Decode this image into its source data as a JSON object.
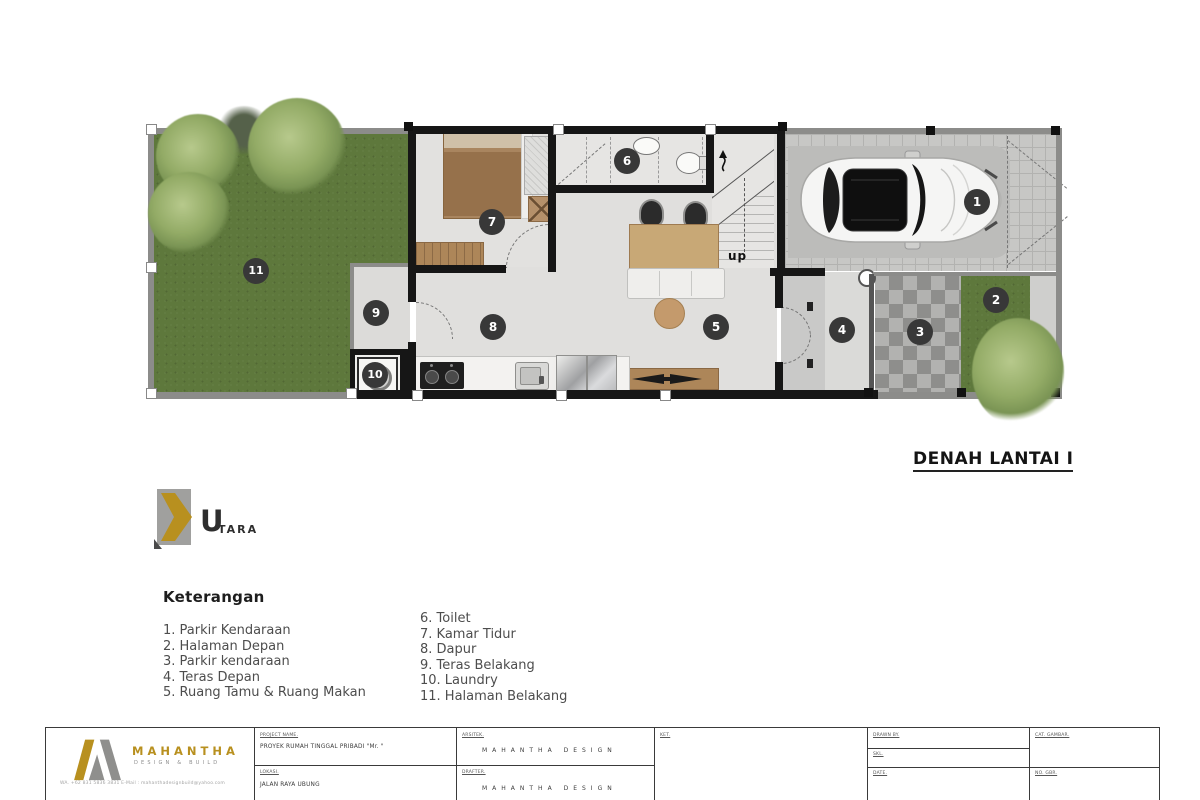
{
  "drawing_title": "DENAH LANTAI I",
  "north": {
    "initial": "U",
    "rest": "TARA"
  },
  "legend_heading": "Keterangan",
  "rooms": [
    {
      "num": "1",
      "name": "Parkir Kendaraan"
    },
    {
      "num": "2",
      "name": "Halaman Depan"
    },
    {
      "num": "3",
      "name": "Parkir kendaraan"
    },
    {
      "num": "4",
      "name": "Teras Depan"
    },
    {
      "num": "5",
      "name": "Ruang Tamu & Ruang Makan"
    },
    {
      "num": "6",
      "name": "Toilet"
    },
    {
      "num": "7",
      "name": "Kamar Tidur"
    },
    {
      "num": "8",
      "name": "Dapur"
    },
    {
      "num": "9",
      "name": "Teras Belakang"
    },
    {
      "num": "10",
      "name": "Laundry"
    },
    {
      "num": "11",
      "name": "Halaman Belakang"
    }
  ],
  "plan_labels": {
    "up": "up"
  },
  "title_block": {
    "company": "MAHANTHA",
    "tagline": "DESIGN & BUILD",
    "contact": "WA. +62 831 5836 3831   E-Mail : mahanthadesignbuild@yahoo.com",
    "fields": {
      "project_label": "PROJECT NAME.",
      "project_value": "PROYEK RUMAH TINGGAL PRIBADI \"Mr. \"",
      "location_label": "LOKASI.",
      "location_value": "JALAN RAYA UBUNG",
      "architect_label": "ARSITEK.",
      "architect_value": "MAHANTHA DESIGN",
      "drafter_label": "DRAFTER.",
      "drafter_value": "MAHANTHA DESIGN",
      "note_label": "KET.",
      "drawn_label": "DRAWN BY.",
      "scale_label": "SKL.",
      "date_label": "DATE.",
      "cat_label": "CAT. GAMBAR.",
      "sheet_label": "NO. GBR."
    }
  },
  "colors": {
    "accent_gold": "#b8901f",
    "badge": "#383838",
    "grass": "#5e783c"
  }
}
